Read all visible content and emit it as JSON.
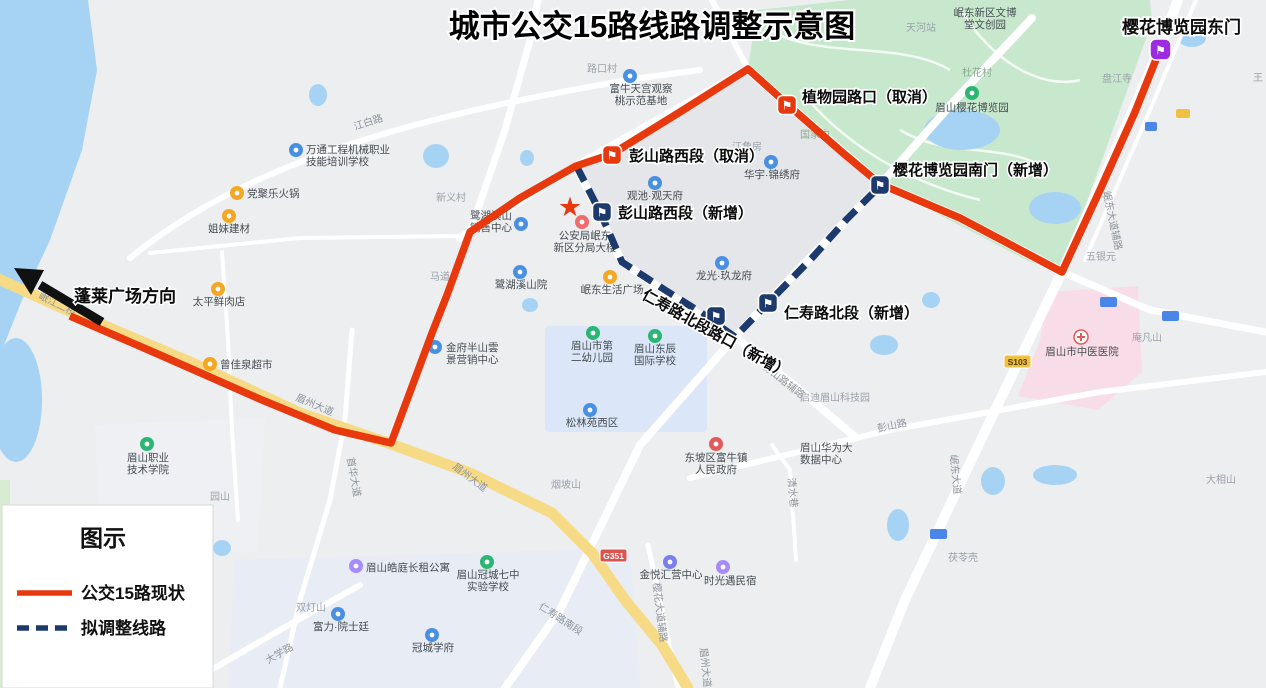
{
  "title": "城市公交15路线路调整示意图",
  "colors": {
    "route_current": "#e8380d",
    "route_adjusted": "#1d3a6d",
    "terminus_marker": "#9d2ce0"
  },
  "legend": {
    "title": "图示",
    "current": "公交15路现状",
    "adjusted": "拟调整线路"
  },
  "direction_label": "蓬莱广场方向",
  "terminus_label": "樱花博览园东门",
  "stops": [
    {
      "label": "彭山路西段（取消）",
      "status": "cancel"
    },
    {
      "label": "植物园路口（取消）",
      "status": "cancel"
    },
    {
      "label": "樱花博览园南门（新增）",
      "status": "new"
    },
    {
      "label": "彭山路西段（新增）",
      "status": "new"
    },
    {
      "label": "仁寿路北段路口（新增）",
      "status": "new"
    },
    {
      "label": "仁寿路北段（新增）",
      "status": "new"
    }
  ],
  "badges": {
    "g351": "G351",
    "s103": "S103"
  },
  "map_labels": {
    "lukoucun": "路口村",
    "funiu1": "富牛天宫观察",
    "funiu2": "桃示范基地",
    "jiangbai_rd": "江白路",
    "wantong1": "万通工程机械职业",
    "wantong2": "技能培训学校",
    "dangju": "党聚乐火锅",
    "jiemei": "姐妹建材",
    "xinyicun": "新义村",
    "luhu1": "鹭湖溪山",
    "luhu2": "销售中心",
    "madaozi": "马道子",
    "luhuyuan": "鹭湖溪山院",
    "gongan1": "公安局岷东",
    "gongan2": "新区分局大楼",
    "mindong_plaza": "岷东生活广场",
    "guanchi": "观池·观天府",
    "huayu": "华宇·锦绣府",
    "jiangjiaofang": "江角房",
    "longguang": "龙光·玖龙府",
    "guojianei": "国家内",
    "yinghuayuan": "眉山樱花博览园",
    "duhuacun": "杜花村",
    "wenbo1": "岷东新区文博",
    "wenbo2": "堂文创园",
    "tianhezhan": "天河站",
    "panjiangsi": "盘江寺",
    "wang": "王",
    "wuyinyuan": "五银元",
    "anfanshan": "庵凡山",
    "zhongyi": "眉山市中医医院",
    "daxiangshan": "大相山",
    "fulingke": "茯苓壳",
    "qidi": "启迪眉山科技园",
    "pengshanlu": "彭山路",
    "pengshanfulu": "彭山路辅路",
    "huawei1": "眉山华为大",
    "huawei2": "数据中心",
    "funiuzhen1": "东坡区富牛镇",
    "funiuzhen2": "人民政府",
    "songlin": "松林苑西区",
    "youeryuan1": "眉山市第",
    "youeryuan2": "二幼儿园",
    "dongchen1": "眉山东辰",
    "dongchen2": "国际学校",
    "yanposhan": "烟坡山",
    "meizhou_dadao": "眉州大道",
    "qingshuixiang": "清水巷",
    "mindong_dadao": "岷东大道",
    "mindong_fulu": "岷东大道辅路",
    "renshou_nanduan": "仁寿路南段",
    "yinghua_fulu": "樱花大道辅路",
    "daxuelu": "大学路",
    "shouhua": "首华大道",
    "yuanshan": "园山",
    "shuangdengshan": "双灯山",
    "zhiyuan1": "眉山职业",
    "zhiyuan2": "技术学院",
    "haoting": "眉山皓庭长租公寓",
    "guancheng71": "眉山冠城七中",
    "guancheng72": "实验学校",
    "fuli": "富力·院士廷",
    "guanchengxuefu": "冠城学府",
    "jinyue": "金悦汇营中心",
    "shiguang": "时光遇民宿",
    "taiping": "太平鲜肉店",
    "chaoshi": "曾佳泉超市",
    "jinfu1": "金府半山雲",
    "jinfu2": "景营销中心",
    "minjiang_bridge": "岷江二桥"
  }
}
